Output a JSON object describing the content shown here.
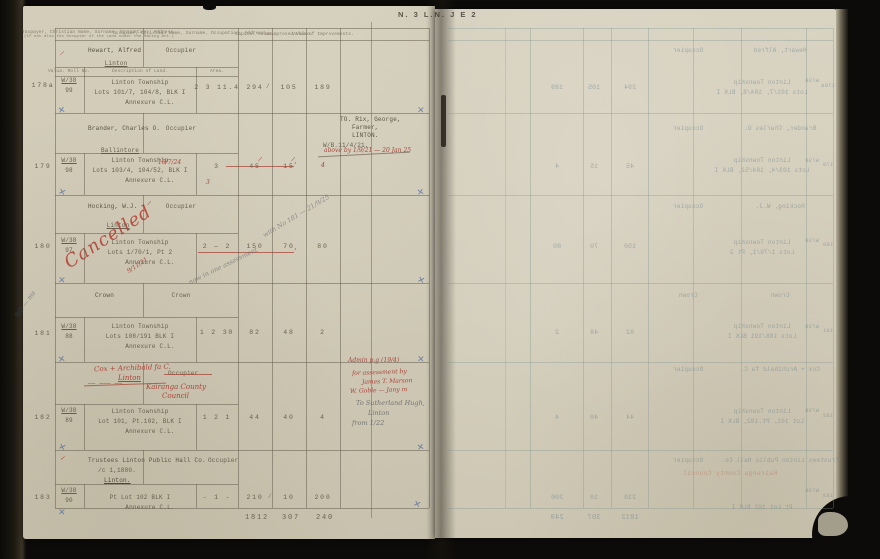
{
  "page_mark": "N. 3  L.N.  J E 2",
  "headers": {
    "taxpayer": "Taxpayer, Christian Name, Surname, Occupation, Address.",
    "taxpayer_sub": "(If not also the Occupier of the Land under the Rating Act.)",
    "occupier": "Occupier, Christian Name, Surname, Occupation, Address.",
    "capital": "Capital Value.",
    "unimproved": "Unimproved Value.",
    "improvements": "Value of Improvements.",
    "roll_no": "Valua. Roll No.",
    "description": "Description of Land.",
    "area": "Area."
  },
  "entries": [
    {
      "num": "178a",
      "ref_top": "W/38",
      "ref_bot": "99",
      "taxpayer": "Hewart, Alfred",
      "address": "Linton",
      "occupier": "Occupier",
      "desc1": "Linton Township",
      "desc2": "Lots 101/7, 104/8, BLK I",
      "desc3": "Annexure C.L.",
      "area": "2 3 11.4",
      "capital": "294",
      "unimproved": "105",
      "improvements": "189"
    },
    {
      "num": "179",
      "ref_top": "W/38",
      "ref_bot": "98",
      "taxpayer": "Brander, Charles O.",
      "address": "Ballintore",
      "occupier": "Occupier",
      "desc1": "Linton Township",
      "desc2": "Lots 103/4, 104/52, BLK I",
      "desc2_red": "10/7/24",
      "desc3": "Annexure C.L.",
      "area": "3",
      "capital": "45",
      "unimproved": "15",
      "improvements": "4",
      "note1": "TO.  Rix, George,",
      "note2": "Farmer,",
      "note3": "LINTON.",
      "note4": "W/B.11/4/21.",
      "note_red": "above by 1/9/21 — 20 Jan 25"
    },
    {
      "num": "180",
      "ref_top": "W/38",
      "ref_bot": "97",
      "taxpayer": "Hocking, W.J.",
      "address": "Linton",
      "occupier": "Occupier",
      "cancel": "Cancelled",
      "cancel_date": "9/11/21",
      "desc1": "Linton Township",
      "desc2": "Lots 1/70/1, Pt 2",
      "desc3": "Annexure C.L.",
      "area": "2 — 2",
      "capital": "150",
      "unimproved": "70",
      "improvements": "80",
      "pencil1": "now in one assessment",
      "pencil2": "with No 181 — 21/9/25"
    },
    {
      "num": "181",
      "ref_top": "W/38",
      "ref_bot": "88",
      "taxpayer": "Crown",
      "occupier": "Crown",
      "desc1": "Linton Township",
      "desc2": "Lots 108/191  BLK I",
      "desc3": "Annexure C.L.",
      "area": "1 2 30",
      "capital": "82",
      "unimproved": "48",
      "improvements": "2",
      "margin_pencil": "9/2 — ms"
    },
    {
      "num": "182",
      "ref_top": "W/38",
      "ref_bot": "89",
      "red_name1": "Cox + Archibald fa C.",
      "red_name2": "Linton",
      "struck": "—— ——— ——",
      "occupier": "Occupier",
      "red_occ1": "Kairanga County",
      "red_occ2": "Council",
      "desc1": "Linton Township",
      "desc2": "Lot 101, Pt.102, BLK I",
      "desc3": "Annexure C.L.",
      "area": "1 2 1",
      "capital": "44",
      "unimproved": "40",
      "improvements": "4",
      "red_top": "Admin p.g (19/4)",
      "red_note1": "for assessment by",
      "red_note2": "James T. Marson",
      "red_note3": "W. Goble — Jany m",
      "pencil1": "To Sutherland Hugh,",
      "pencil2": "Linton",
      "pencil3": "from 1/22"
    },
    {
      "num": "183",
      "ref_top": "W/38",
      "ref_bot": "90",
      "taxpayer": "Trustees Linton Public Hall Co.",
      "taxpayer2": "/c 1,1880.",
      "address": "Linton.",
      "occupier": "Occupier",
      "desc2": "Pt Lot 102  BLK I",
      "desc3": "Annexure C.L.",
      "area": "-  1  -",
      "capital": "210",
      "unimproved": "10",
      "improvements": "200"
    }
  ],
  "totals": {
    "capital": "1812",
    "unimproved": "307",
    "improvements": "240"
  }
}
